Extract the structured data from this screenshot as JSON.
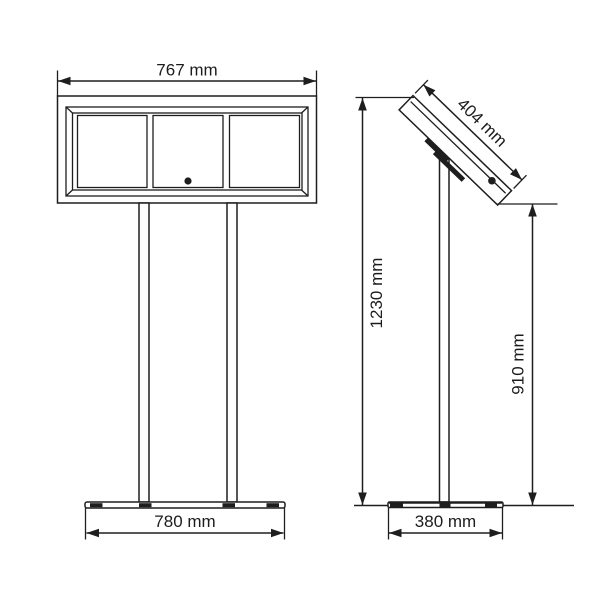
{
  "front_view": {
    "board_width_label": "767 mm",
    "base_width_label": "780 mm"
  },
  "side_view": {
    "display_depth_label": "404 mm",
    "total_height_label": "1230 mm",
    "display_underside_height_label": "910 mm",
    "base_depth_label": "380 mm"
  },
  "colors": {
    "line": "#1e1e1e",
    "background": "#ffffff"
  }
}
